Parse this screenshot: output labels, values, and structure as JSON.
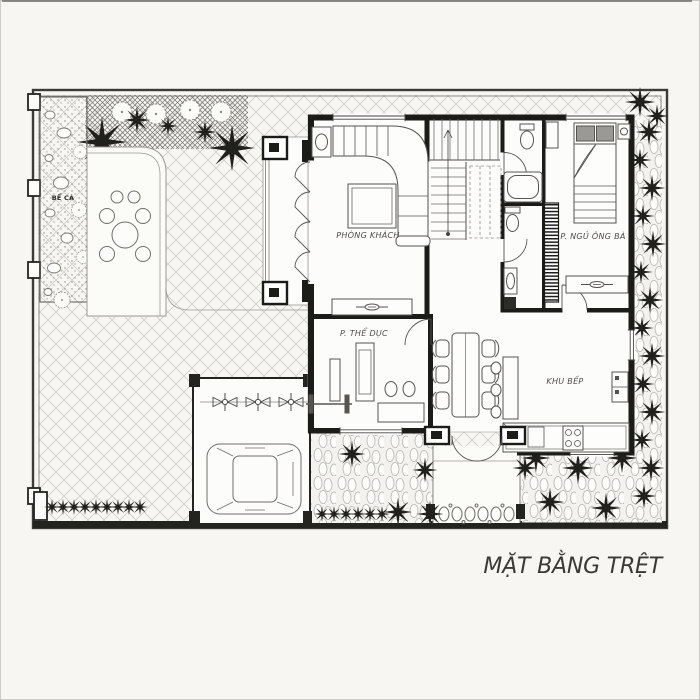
{
  "drawing": {
    "type": "architectural ground floor plan",
    "title": "MẶT BẰNG TRỆT"
  },
  "rooms": {
    "fish_pond": "BỂ CÁ",
    "living_room": "PHÒNG KHÁCH",
    "master_bedroom": "P. NGỦ ÔNG BÀ",
    "gym": "P. THỂ DỤC",
    "kitchen": "KHU BẾP"
  },
  "colors": {
    "paper": "#f7f6f3",
    "wall_ink": "#1b1b18",
    "furniture_line": "#55544f",
    "hatch_light": "#c2c1bd",
    "hatch_dense": "#77766f",
    "plant_dark": "#20201c"
  }
}
